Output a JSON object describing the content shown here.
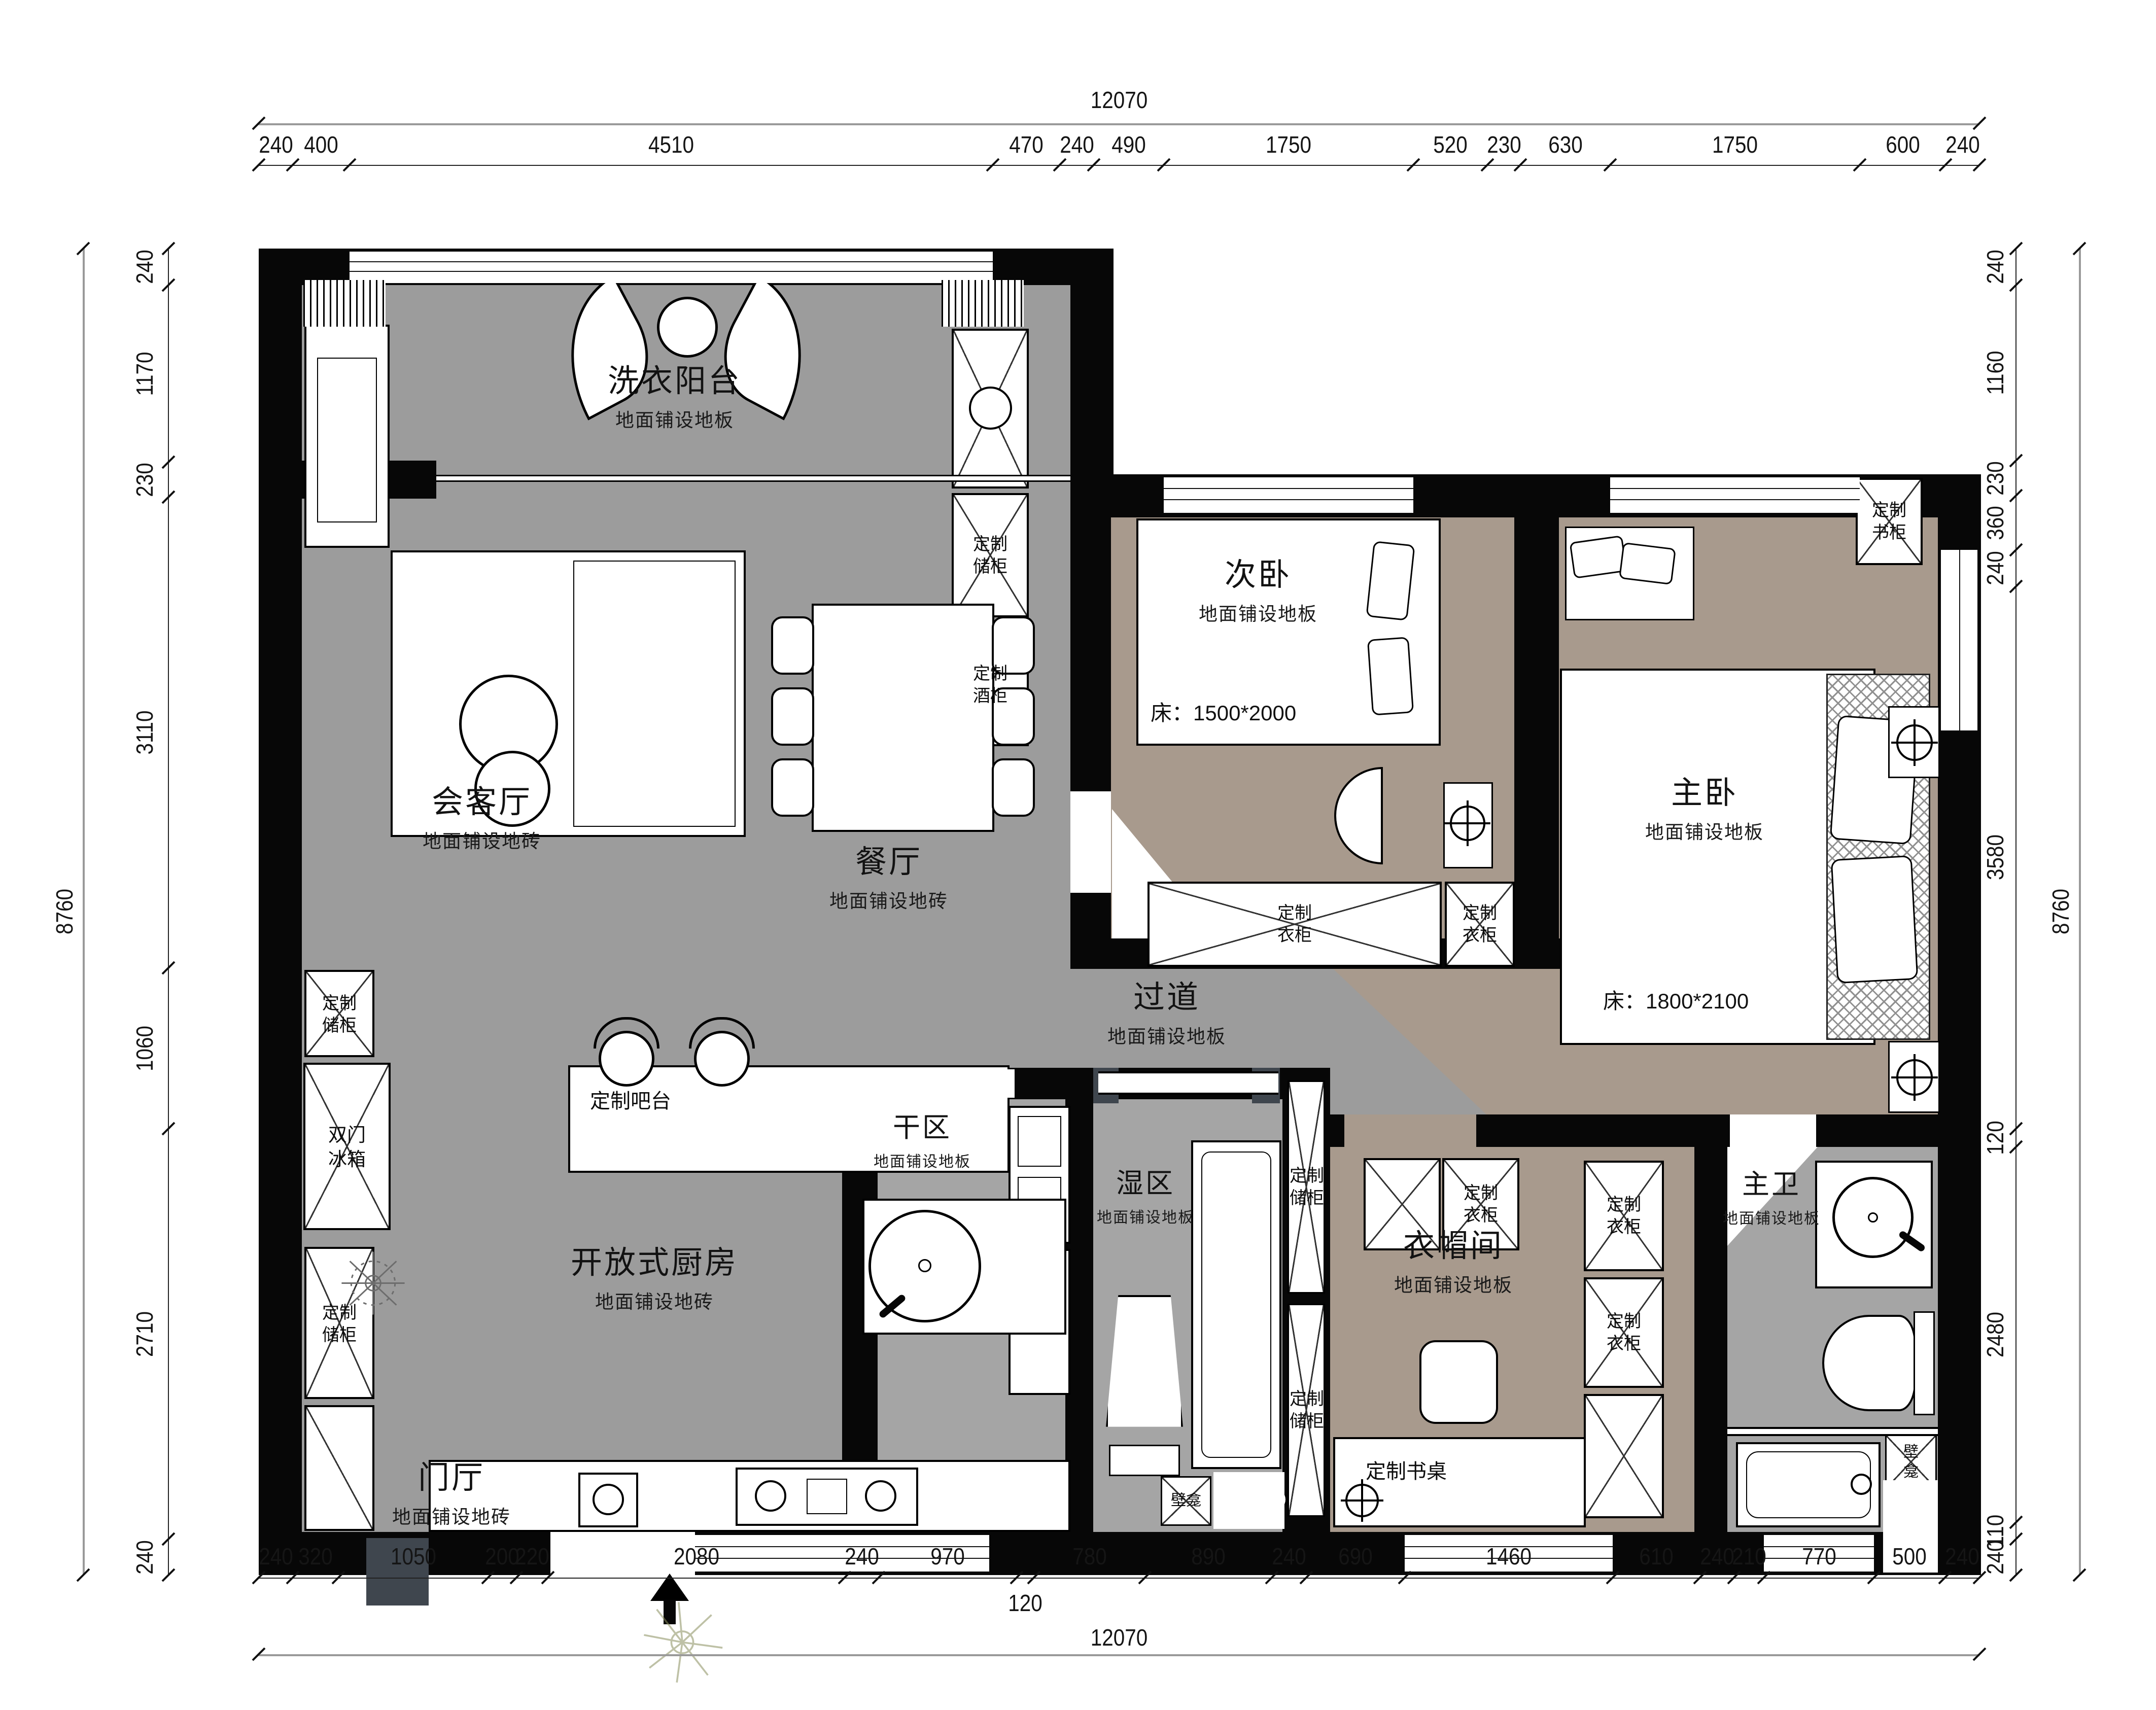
{
  "plan": {
    "overall_width": "12070",
    "overall_height": "8760",
    "dim_top": [
      "240",
      "400",
      "4510",
      "470",
      "240",
      "490",
      "1750",
      "520",
      "230",
      "630",
      "1750",
      "600",
      "240"
    ],
    "dim_bottom": [
      "240",
      "320",
      "1050",
      "200",
      "220",
      "2080",
      "240",
      "970",
      "120",
      "780",
      "890",
      "240",
      "690",
      "1460",
      "610",
      "240",
      "210",
      "770",
      "500",
      "240"
    ],
    "dim_left": [
      "240",
      "1170",
      "230",
      "3110",
      "1060",
      "2710",
      "240"
    ],
    "dim_right": [
      "240",
      "1160",
      "230",
      "360",
      "240",
      "3580",
      "120",
      "2480",
      "110",
      "240"
    ]
  },
  "rooms": {
    "laundry": {
      "name": "洗衣阳台",
      "floor": "地面铺设地板"
    },
    "living": {
      "name": "会客厅",
      "floor": "地面铺设地砖"
    },
    "dining": {
      "name": "餐厅",
      "floor": "地面铺设地砖"
    },
    "bedroom2": {
      "name": "次卧",
      "floor": "地面铺设地板",
      "bed": "床：1500*2000"
    },
    "master": {
      "name": "主卧",
      "floor": "地面铺设地板",
      "bed": "床：1800*2100"
    },
    "hallway": {
      "name": "过道",
      "floor": "地面铺设地板"
    },
    "dry": {
      "name": "干区",
      "floor": "地面铺设地板"
    },
    "wet": {
      "name": "湿区",
      "floor": "地面铺设地板"
    },
    "closet": {
      "name": "衣帽间",
      "floor": "地面铺设地板"
    },
    "master_bath": {
      "name": "主卫",
      "floor": "地面铺设地板"
    },
    "kitchen": {
      "name": "开放式厨房",
      "floor": "地面铺设地砖"
    },
    "foyer": {
      "name": "门厅",
      "floor": "地面铺设地砖"
    }
  },
  "fixtures": {
    "storage": {
      "l1": "定制",
      "l2": "储柜"
    },
    "wine": {
      "l1": "定制",
      "l2": "酒柜"
    },
    "book": {
      "l1": "定制",
      "l2": "书柜"
    },
    "wardrobe": {
      "l1": "定制",
      "l2": "衣柜"
    },
    "fridge": {
      "l1": "双门",
      "l2": "冰箱"
    },
    "niche": {
      "l1": "壁",
      "l2": "龛",
      "full": "壁龛"
    },
    "desk": "定制书桌",
    "bar": "定制吧台"
  },
  "colors": {
    "floor_gray": "#9c9c9c",
    "floor_bath": "#a5a5a5",
    "floor_taupe": "#a89a8d",
    "wall": "#070707",
    "door_slate": "#3f464e"
  }
}
